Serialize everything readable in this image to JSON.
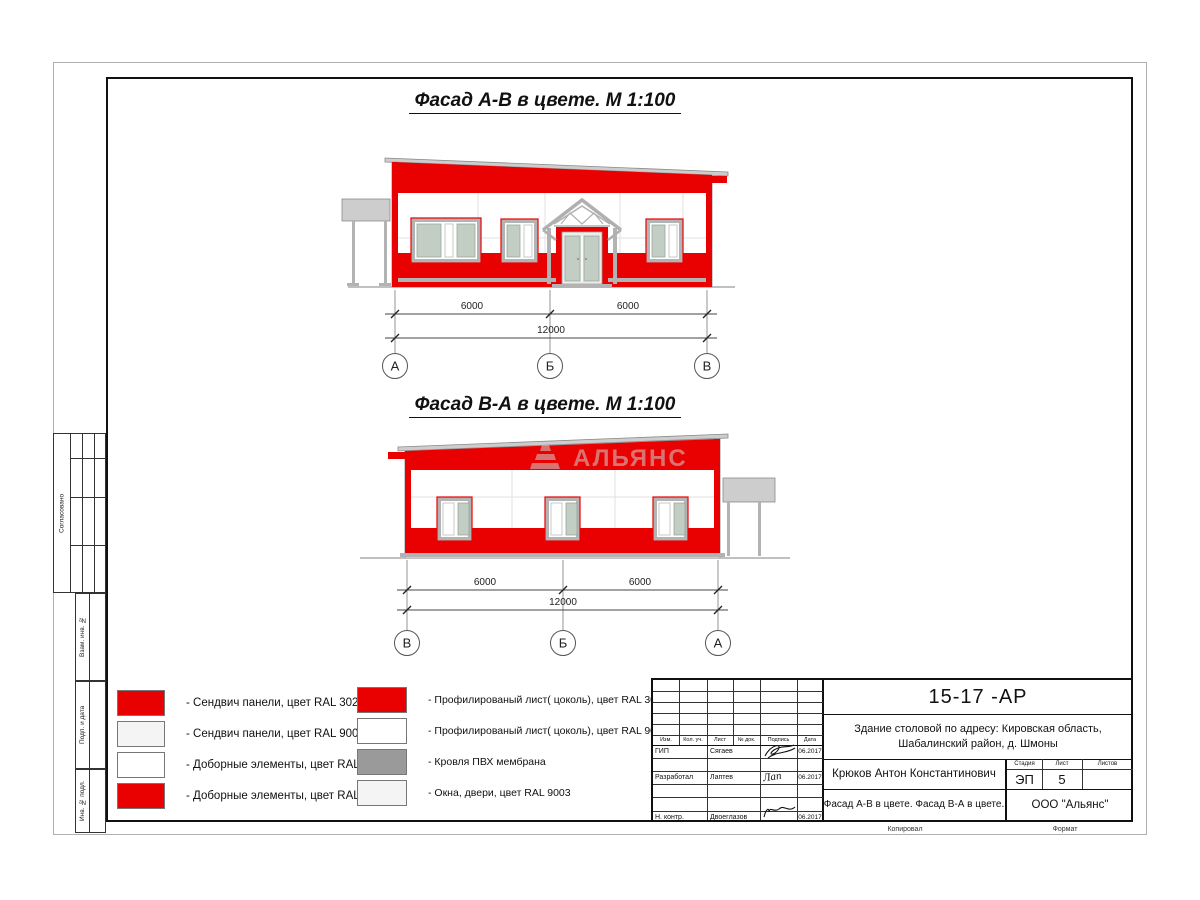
{
  "colors": {
    "red": "#e90000",
    "glass": "#c2cdc3",
    "canopy_gray": "#cdcdcd",
    "frame_gray": "#b3b3b3",
    "membrane_gray": "#9a9a9a",
    "light": "#f4f4f4",
    "watermark_gray": "#cfcfcf"
  },
  "titles": {
    "facade1": "Фасад А-В в цвете.  М 1:100",
    "facade2": "Фасад В-А в цвете.  М 1:100"
  },
  "watermark": "АЛЬЯНС",
  "dims": {
    "f1": {
      "d1": "6000",
      "d2": "6000",
      "total": "12000",
      "axes": [
        "А",
        "Б",
        "В"
      ]
    },
    "f2": {
      "d1": "6000",
      "d2": "6000",
      "total": "12000",
      "axes": [
        "В",
        "Б",
        "А"
      ]
    }
  },
  "legend": {
    "left": [
      {
        "label": "- Сендвич панели, цвет RAL 3020",
        "color": "#e90000"
      },
      {
        "label": "- Сендвич панели, цвет RAL 9003",
        "color": "#f4f4f4"
      },
      {
        "label": "- Доборные элементы, цвет RAL 9003",
        "color": "#ffffff"
      },
      {
        "label": "- Доборные элементы, цвет RAL 3020",
        "color": "#e90000"
      }
    ],
    "right": [
      {
        "label": "- Профилированый лист( цоколь), цвет RAL 3020",
        "color": "#e90000"
      },
      {
        "label": "- Профилированый лист( цоколь), цвет RAL 9003",
        "color": "#ffffff"
      },
      {
        "label": "- Кровля ПВХ мембрана",
        "color": "#9a9a9a"
      },
      {
        "label": "- Окна, двери, цвет RAL 9003",
        "color": "#f4f4f4"
      }
    ]
  },
  "side_labels": [
    "Согласовано",
    "Взам. инв. №",
    "Подп. и дата",
    "Инв. № подл."
  ],
  "stamp": {
    "doc_code": "15-17 -АР",
    "project": "Здание столовой по адресу: Кировская область, Шабалинский район, д. Шмоны",
    "columns": [
      "Изм.",
      "Кол. уч.",
      "Лист",
      "№ док.",
      "Подпись",
      "Дата"
    ],
    "rows": [
      {
        "role": "ГИП",
        "name": "Сягаев",
        "date": "06.2017"
      },
      {
        "role": "Разработал",
        "name": "Лаптев",
        "sig": "Лап",
        "date": "06.2017"
      },
      {
        "role": "Н. контр.",
        "name": "Двоеглазов",
        "date": "06.2017"
      }
    ],
    "chief": "Крюков Антон Константинович",
    "stage_label": "Стадия",
    "sheet_label": "Лист",
    "sheets_label": "Листов",
    "stage": "ЭП",
    "sheet_num": "5",
    "sheets": "",
    "subtitle": "Фасад А-В в цвете. Фасад В-А в цвете.",
    "company": "ООО \"Альянс\"",
    "copied_label": "Копировал",
    "format_label": "Формат"
  }
}
